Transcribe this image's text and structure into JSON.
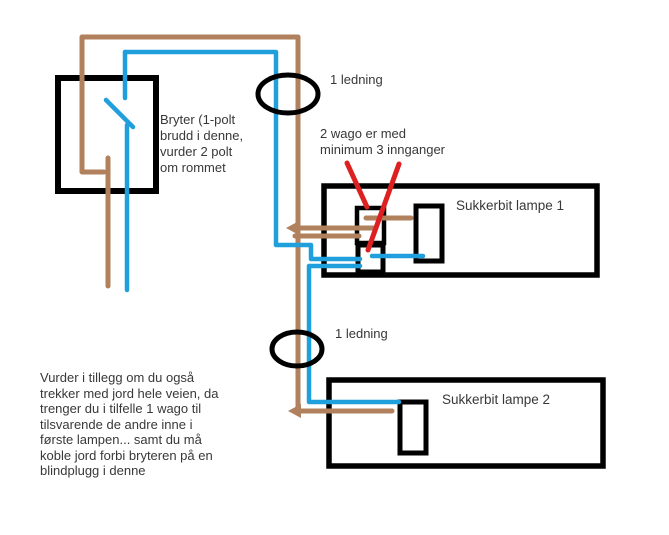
{
  "colors": {
    "wire_brown": "#b1805c",
    "wire_blue": "#1f9fdb",
    "pointer_red": "#dd2020",
    "outline": "#000000"
  },
  "labels": {
    "switch_note": "Bryter (1-polt\nbrudd i denne,\nvurder 2 polt\nom rommet",
    "top_wire": "1 ledning",
    "wago_note": "2 wago er med\nminimum 3 innganger",
    "lamp1": "Sukkerbit lampe 1",
    "mid_wire": "1 ledning",
    "lamp2": "Sukkerbit lampe 2",
    "ground_note": "Vurder i tillegg om du også\ntrekker med jord hele veien, da\ntrenger du i tilfelle 1 wago til\ntilsvarende de andre inne i\nførste lampen... samt du må\nkoble jord forbi bryteren på en\nblindplugg i denne"
  }
}
